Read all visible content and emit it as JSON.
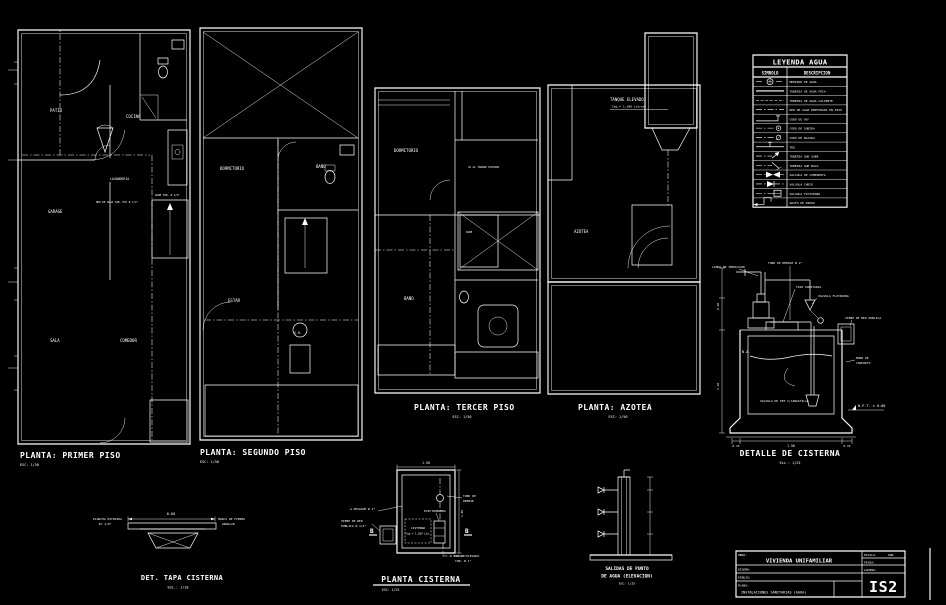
{
  "sheet": {
    "bg": "#000000",
    "ink": "#ffffff"
  },
  "plans": {
    "p1": {
      "title": "PLANTA: PRIMER  PISO",
      "scale": "ESC: 1/50",
      "rooms": {
        "patio": "PATIO",
        "cocina": "COCINA",
        "lavanderia": "LAVANDERIA",
        "garage": "GARAGE",
        "sala": "SALA",
        "comedor": "COMEDOR"
      },
      "notes": {
        "red": "RED DE AGUA TUB. PVC Ø 1/2\"",
        "sube": "SUBE TUB. Ø 3/4\""
      }
    },
    "p2": {
      "title": "PLANTA: SEGUNDO  PISO",
      "scale": "ESC: 1/50",
      "rooms": {
        "dormitorio": "DORMITORIO",
        "bano": "BAÑO",
        "estar": "ESTAR",
        "sh": "S.H."
      }
    },
    "p3": {
      "title": "PLANTA: TERCER  PISO",
      "scale": "ESC: 1/50",
      "rooms": {
        "dormitorio": "DORMITORIO",
        "bano": "BAÑO"
      },
      "notes": {
        "tanque": "VA AL TANQUE ELEVADO",
        "sube": "SUBE"
      }
    },
    "p4": {
      "title": "PLANTA: AZOTEA",
      "scale": "ESC: 1/50",
      "rooms": {
        "azotea": "AZOTEA"
      },
      "notes": {
        "tanque": "TANQUE  ELEVADO",
        "cap": "Cap.= 1,100 Litros"
      }
    }
  },
  "legend": {
    "title": "LEYENDA AGUA",
    "col_symbol": "SIMBOLO",
    "col_desc": "DESCRIPCION",
    "rows": [
      {
        "symbol": "water-meter",
        "desc": "MEDIDOR DE AGUA"
      },
      {
        "symbol": "line-solid",
        "desc": "TUBERIA DE AGUA FRIA"
      },
      {
        "symbol": "line-dashed",
        "desc": "TUBERIA DE AGUA CALIENTE"
      },
      {
        "symbol": "line-dashdot",
        "desc": "RED DE AGUA EMPOTRADA EN PISO"
      },
      {
        "symbol": "elbow-90",
        "desc": "CODO DE 90°"
      },
      {
        "symbol": "elbow-up",
        "desc": "CODO DE SUBIDA"
      },
      {
        "symbol": "elbow-down",
        "desc": "CODO DE BAJADA"
      },
      {
        "symbol": "tee",
        "desc": "TEE"
      },
      {
        "symbol": "pipe-up",
        "desc": "TUBERIA QUE SUBE"
      },
      {
        "symbol": "pipe-down",
        "desc": "TUBERIA QUE BAJA"
      },
      {
        "symbol": "gate-valve",
        "desc": "VALVULA DE COMPUERTA"
      },
      {
        "symbol": "check-valve",
        "desc": "VALVULA CHECK"
      },
      {
        "symbol": "float-valve",
        "desc": "VALVULA FLOTADORA"
      },
      {
        "symbol": "faucet",
        "desc": "GRIFO DE RIEGO"
      }
    ]
  },
  "details": {
    "cisterna": {
      "title": "DETALLE DE CISTERNA",
      "scale": "Esc.: 1/25",
      "labels": {
        "impulsion": "LINEA DE IMPULSION",
        "rebose": "TUBO DE REBOSE Ø 2\"",
        "tapa": "TAPA SANITARIA",
        "flotadora": "VALVULA FLOTADORA",
        "viene": "VIENE DE RED PUBLICA",
        "muro1": "MURO DE",
        "muro2": "CONCRETO",
        "pie": "VALVULA DE PIE C/CANASTILLA",
        "na": "N.A.",
        "npt": "N.P.T. ± 0.00"
      },
      "dims": {
        "w1": "0.15",
        "w2": "1.50",
        "w3": "0.15",
        "h1": "0.60",
        "h2": "1.20"
      }
    },
    "tapa": {
      "title": "DET. TAPA CISTERNA",
      "scale": "ESC.: 1/10",
      "labels": {
        "left1": "PLANCHA ESTRIADA",
        "left2": "E= 1/8\"",
        "right1": "MARCO DE FIERRO",
        "right2": "ANGULAR",
        "dim": "0.60"
      }
    },
    "planta_cisterna": {
      "title": "PLANTA CISTERNA",
      "scale": "ESC: 1/25",
      "labels": {
        "name": "CISTERNA",
        "cap": "Cap.= 1,500 Lts.",
        "bomba": "ELECTROBOMBA",
        "viene1": "VIENE DE RED",
        "viene2": "PUBLICA Ø 3/4\"",
        "desague": "A DESAGUE Ø 2\"",
        "tanque1": "A TANQUE ELEVADO",
        "tanque2": "TUB. Ø 1\"",
        "rebose1": "TUBO DE",
        "rebose2": "REBOSE",
        "section": "B",
        "dim_top": "1.50",
        "dim_side": "1.85"
      }
    },
    "salidas": {
      "title1": "SALIDAS  DE  PUNTO",
      "title2": "DE  AGUA  (ELEVACION)",
      "scale": "ESC: 1/25"
    }
  },
  "titleblock": {
    "obra_label": "OBRA:",
    "obra": "VIVIENDA UNIFAMILIAR",
    "row2_label": "DISEÑO:",
    "row3_label": "DIBUJO:",
    "plano_label": "PLANO:",
    "plano": "INSTALACIONES SANITARIAS (AGUA)",
    "escala_label": "ESCALA:",
    "escala": "IND.",
    "fecha_label": "FECHA:",
    "lamina_label": "LAMINA:",
    "lamina": "IS2"
  }
}
